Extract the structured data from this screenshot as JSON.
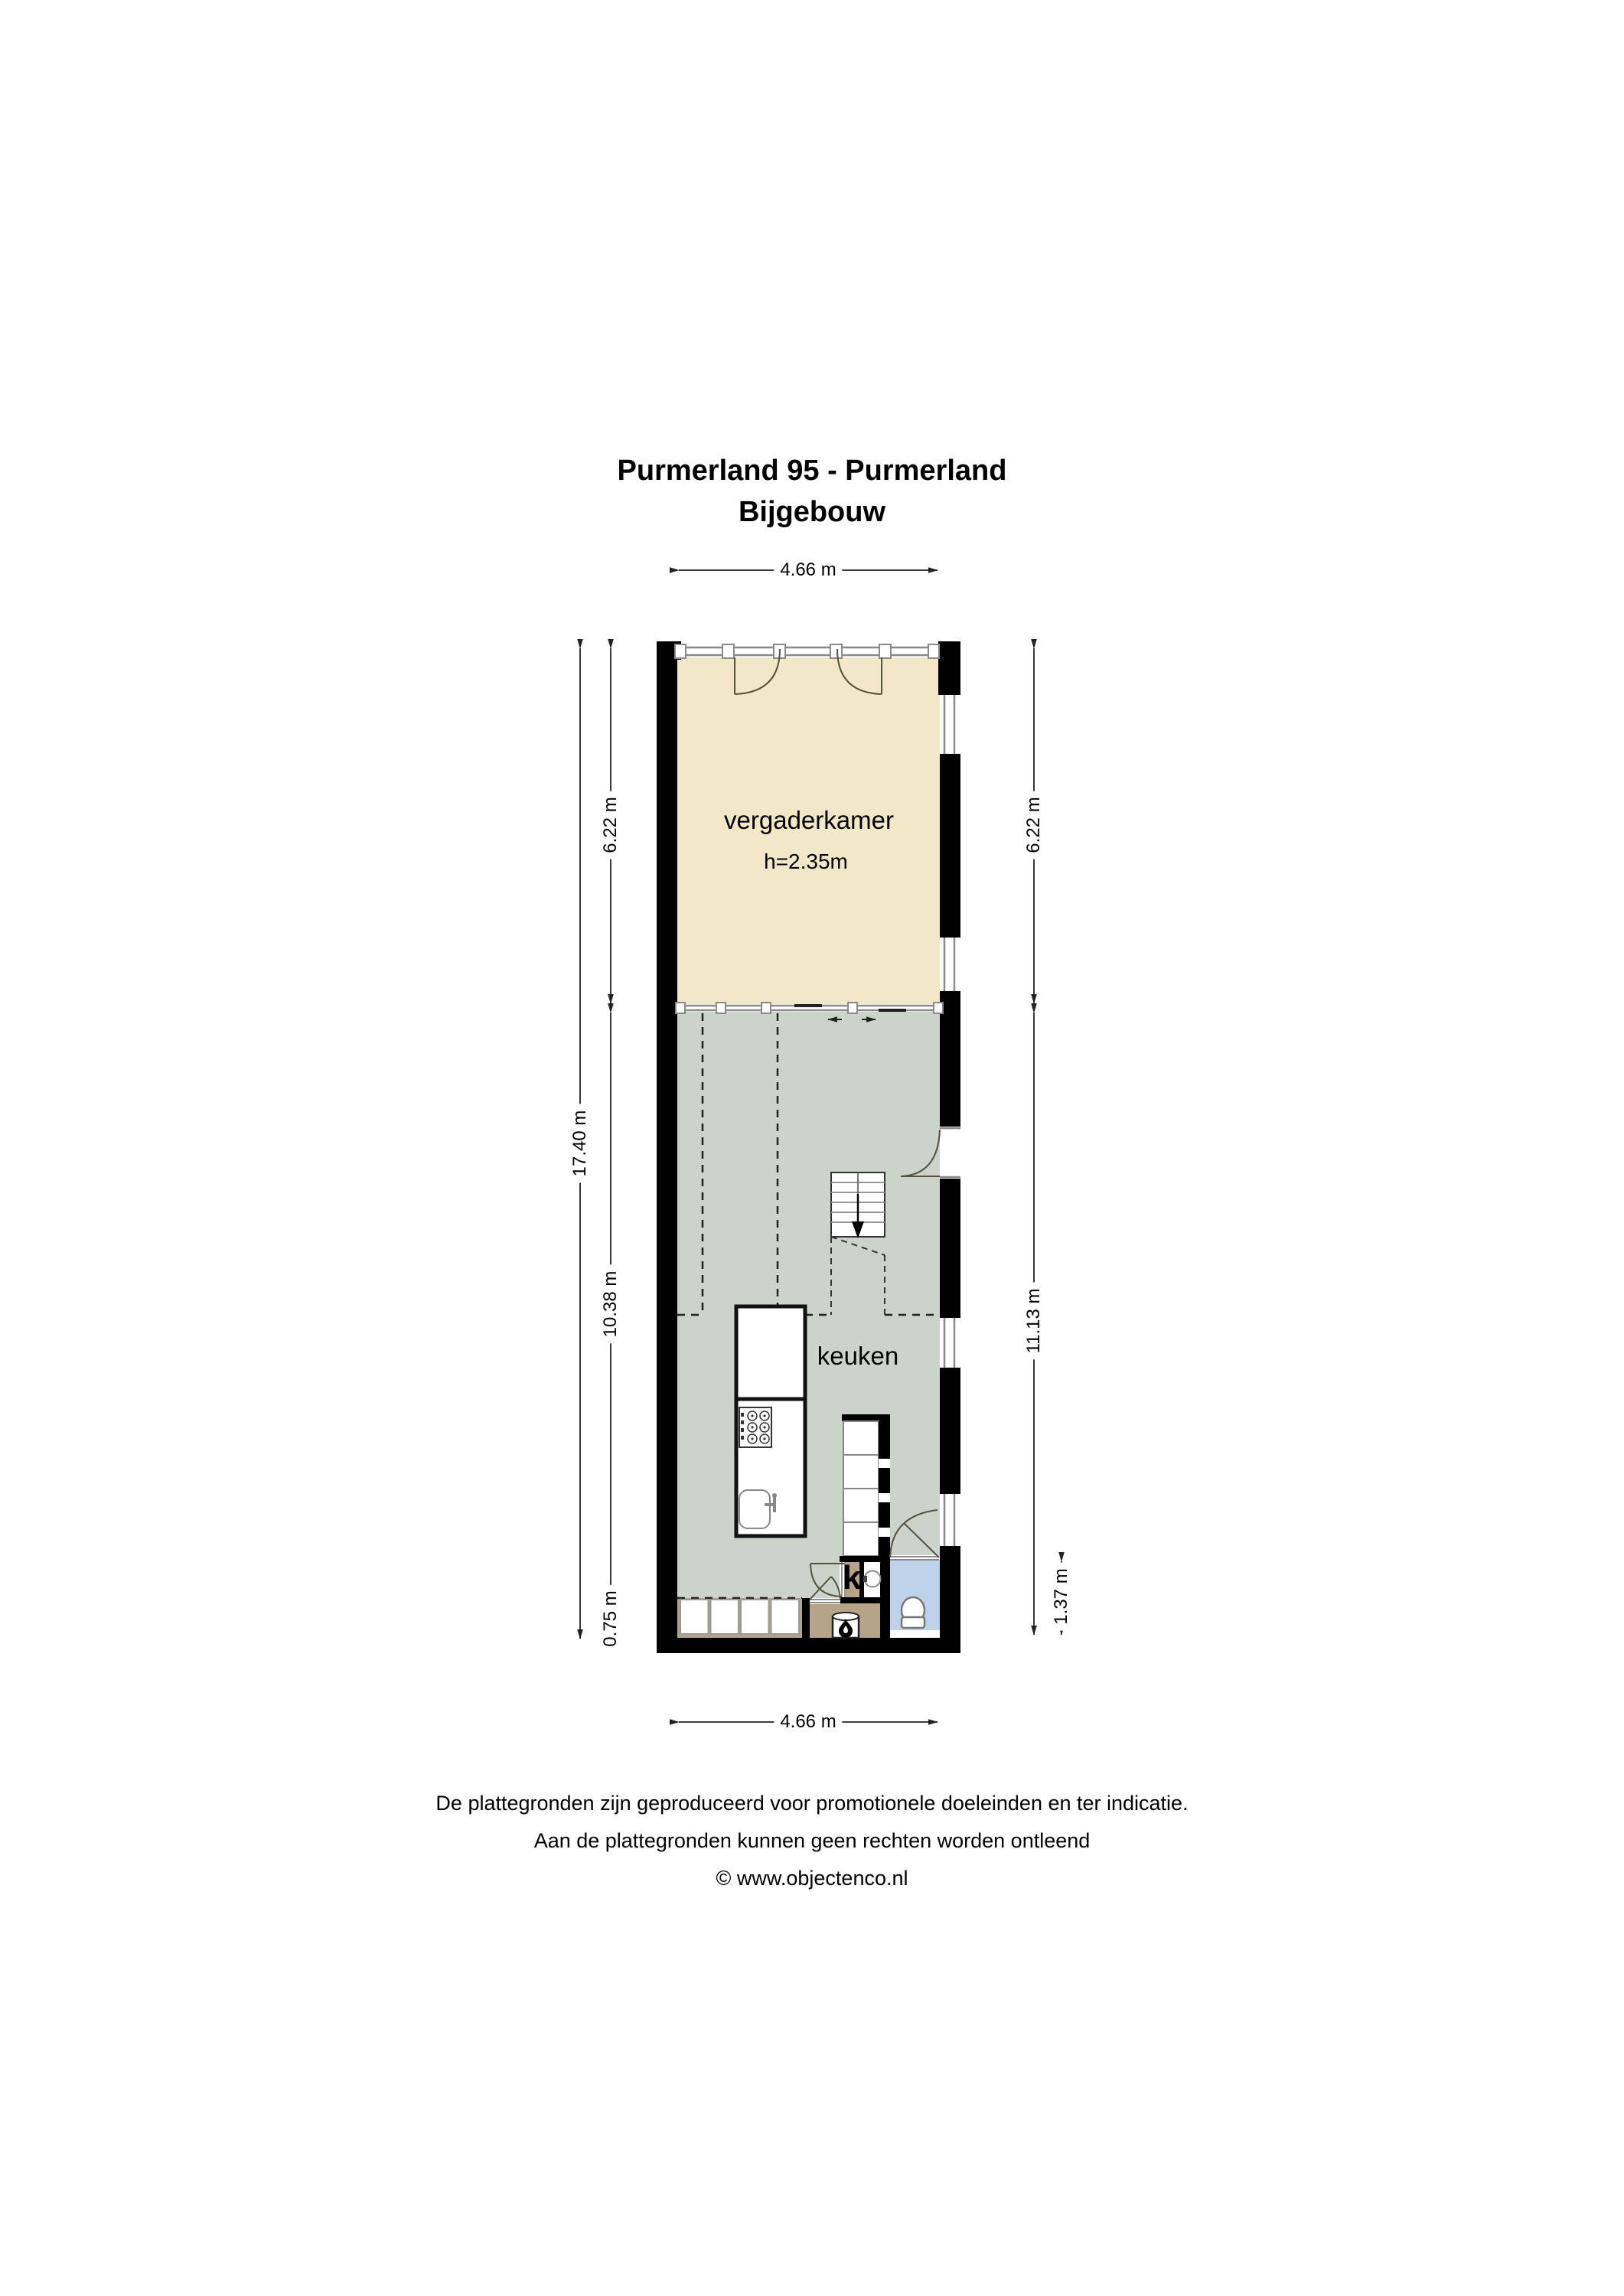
{
  "title": {
    "line1": "Purmerland 95 - Purmerland",
    "line2": "Bijgebouw"
  },
  "rooms": {
    "vergaderkamer": {
      "label": "vergaderkamer",
      "ceiling_height": "h=2.35m"
    },
    "keuken": {
      "label": "keuken"
    },
    "closet": {
      "label": "k"
    }
  },
  "dimensions": {
    "top_width": "4.66 m",
    "bottom_width": "4.66 m",
    "left_total": "17.40 m",
    "left_upper": "6.22 m",
    "left_middle": "10.38 m",
    "left_bottom": "0.75 m",
    "right_upper": "6.22 m",
    "right_middle": "11.13 m",
    "right_bottom": "1.37 m"
  },
  "footer": {
    "line1": "De plattegronden zijn geproduceerd voor promotionele doeleinden en ter indicatie.",
    "line2": "Aan de plattegronden kunnen geen rechten worden ontleend",
    "line3": "© www.objectenco.nl"
  },
  "colors": {
    "wall": "#000000",
    "vergaderkamer_floor": "#f2e8c7",
    "keuken_floor": "#cbd3ca",
    "utility_floor": "#b5a488",
    "wc_floor": "#bed3e9",
    "window_line": "#8a8a8a",
    "dimension_line": "#222222"
  },
  "icons": {
    "stairs_direction": "down-arrow-icon",
    "stove": "flame-icon",
    "toilet": "toilet-icon",
    "washbasin": "round-basin-icon",
    "hob": "gas-hob-icon",
    "sink": "sink-icon"
  }
}
